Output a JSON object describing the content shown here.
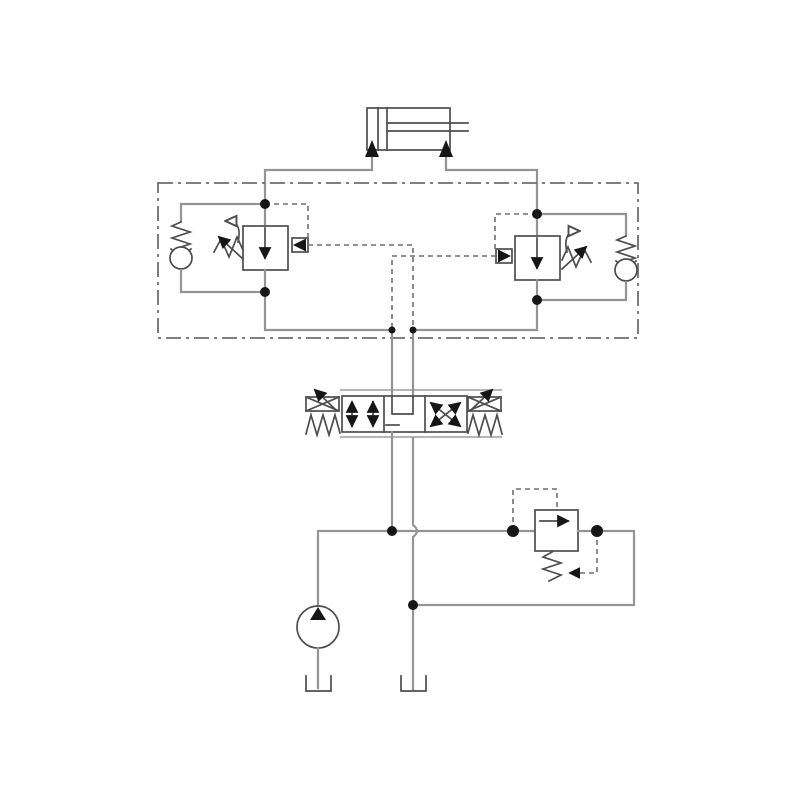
{
  "page": {
    "title": "Hydraulic circuit diagram",
    "description": "Schematic of a double-acting cylinder controlled by dual counterbalance valves, a 4/3 proportional directional control valve, a fixed displacement pump with pressure relief valve and tank returns",
    "background": "#ffffff"
  },
  "colors": {
    "pipe_gray": "#949494",
    "symbol_gray": "#4d4d4d",
    "pilot_dash_gray": "#6f6f6f",
    "solid_black": "#161616",
    "background": "#ffffff"
  },
  "components": {
    "cylinder": "double-acting hydraulic cylinder with piston rod",
    "enclosure": "dash-dot manifold enclosure containing dual counterbalance valves",
    "left_counterbalance_valve": "counterbalance valve with check valve, adjustable spring and external pilot",
    "right_counterbalance_valve": "mirrored counterbalance valve with check valve, adjustable spring and external pilot",
    "directional_valve": "4/3 proportional directional control valve, spring centered, solenoid operated",
    "relief_valve": "pilot operated pressure relief valve",
    "pump": "fixed displacement hydraulic pump",
    "tanks": "two reservoir (tank) symbols"
  }
}
